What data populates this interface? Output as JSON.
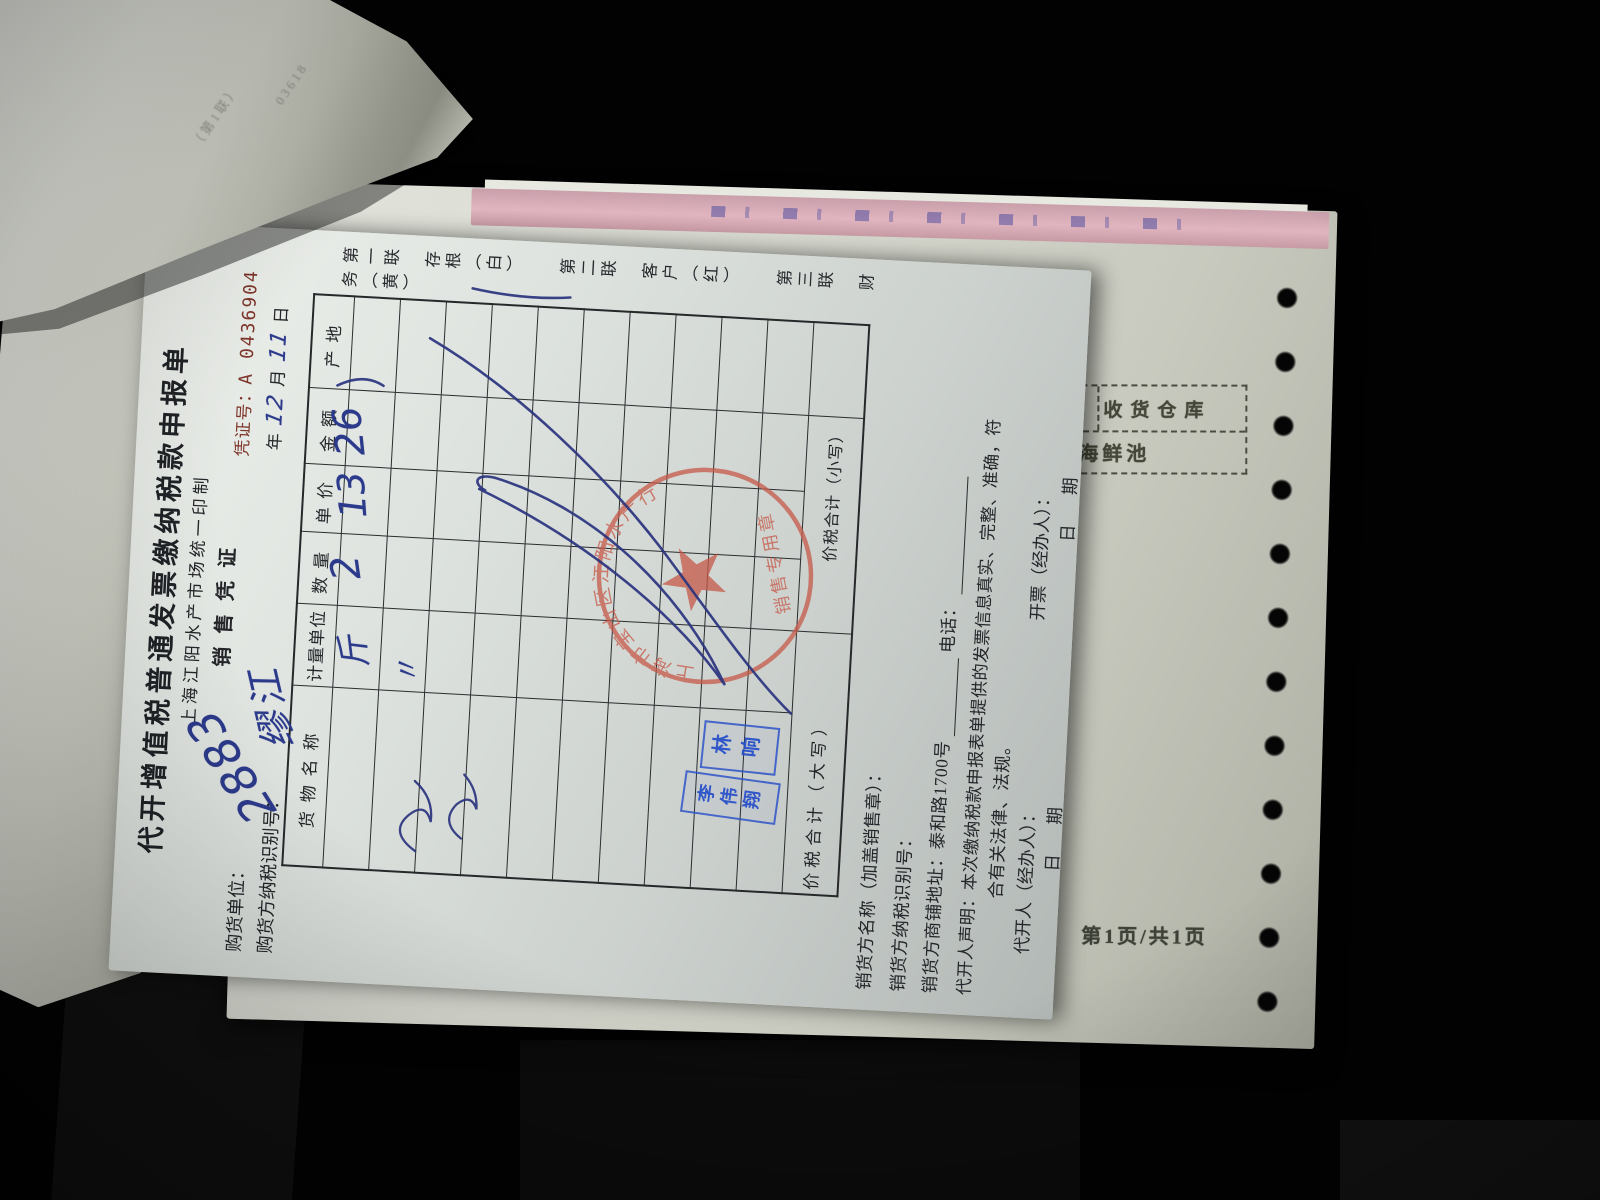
{
  "colors": {
    "seal_red": "#c65948",
    "stamp_blue": "#2f55c8",
    "ink_blue": "#2c3a8c",
    "serial_red": "#7e352a"
  },
  "overlay_paper": {
    "fragments": [
      "（第1联）",
      "03618"
    ]
  },
  "under_sheet": {
    "receive_box": {
      "title": "收货仓库",
      "value": "海鲜池"
    },
    "page_footer": "第1页/共1页"
  },
  "invoice": {
    "title": "代开增值税普通发票缴纳税款申报单",
    "printer_line": "上海江阳水产市场统一印制",
    "doc_type": "销售凭证",
    "copies": "第一联　存根（白）　　第二联　客户（红）　　第三联　财务（黄）",
    "voucher_no_label": "凭证号：",
    "voucher_no": "A 0436904",
    "buyer_label": "购货单位：",
    "buyer_value": "2883",
    "buyer_tax_id_label": "购货方纳税识别号：",
    "buyer_tax_id_value": "缪江",
    "date": {
      "year_label": "年",
      "month_value": "12",
      "month_label": "月",
      "day_value": "11",
      "day_label": "日"
    },
    "table": {
      "headers": [
        "货物名称",
        "计量单位",
        "数量",
        "单价",
        "金额",
        "产地"
      ],
      "rows": [
        {
          "name": "",
          "unit": "斤",
          "qty": "2",
          "price": "13",
          "amount": "26",
          "origin": ""
        },
        {
          "name": "",
          "unit": "〃",
          "qty": "",
          "price": "",
          "amount": "",
          "origin": ""
        }
      ],
      "total_upper_label": "价税合计（大写）",
      "total_lower_label": "价税合计（小写）"
    },
    "seller_name_label": "销货方名称（加盖销售章）：",
    "seller_tax_id_label": "销货方纳税识别号：",
    "seller_addr_label": "销货方商铺地址：",
    "seller_addr_value": "泰和路1700号",
    "phone_label": "电话：",
    "declaration_line1": "代开人声明：本次缴纳税款申报表单提供的发票信息真实、完整、准确，符",
    "declaration_line2": "合有关法律、法规。",
    "agent_label": "代开人（经办人）：",
    "agent_date_label": "日　期",
    "issuer_label": "开票（经办人）：",
    "issuer_date_label": "日　期",
    "seal": {
      "arc_text": "上海市宝山区江阳水产行",
      "center_text": "销售专用章"
    },
    "stamps": [
      {
        "name": "林响"
      },
      {
        "name": "李伟翔"
      }
    ]
  }
}
